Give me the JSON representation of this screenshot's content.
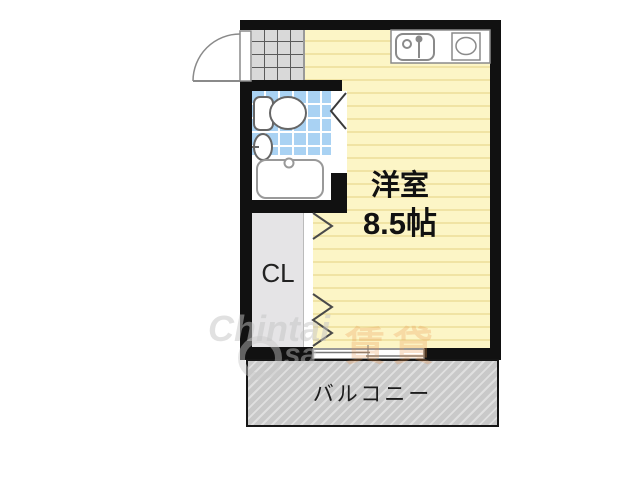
{
  "floorplan": {
    "main_room": {
      "name": "洋室",
      "size": "8.5帖"
    },
    "closet": {
      "label": "CL"
    },
    "balcony": {
      "label": "バルコニー"
    },
    "colors": {
      "wall": "#111111",
      "room_floor": "#fcf5c6",
      "room_floor_stripe": "#f0e3a4",
      "bath_tile": "#a9d2f3",
      "genkan_tile": "#d9d9d9",
      "closet_fill": "#e5e4e6",
      "balcony_fill": "#c9c9c9"
    }
  },
  "watermark": {
    "brand": "Chintai",
    "sub": "sa",
    "accent": "賃貸"
  }
}
